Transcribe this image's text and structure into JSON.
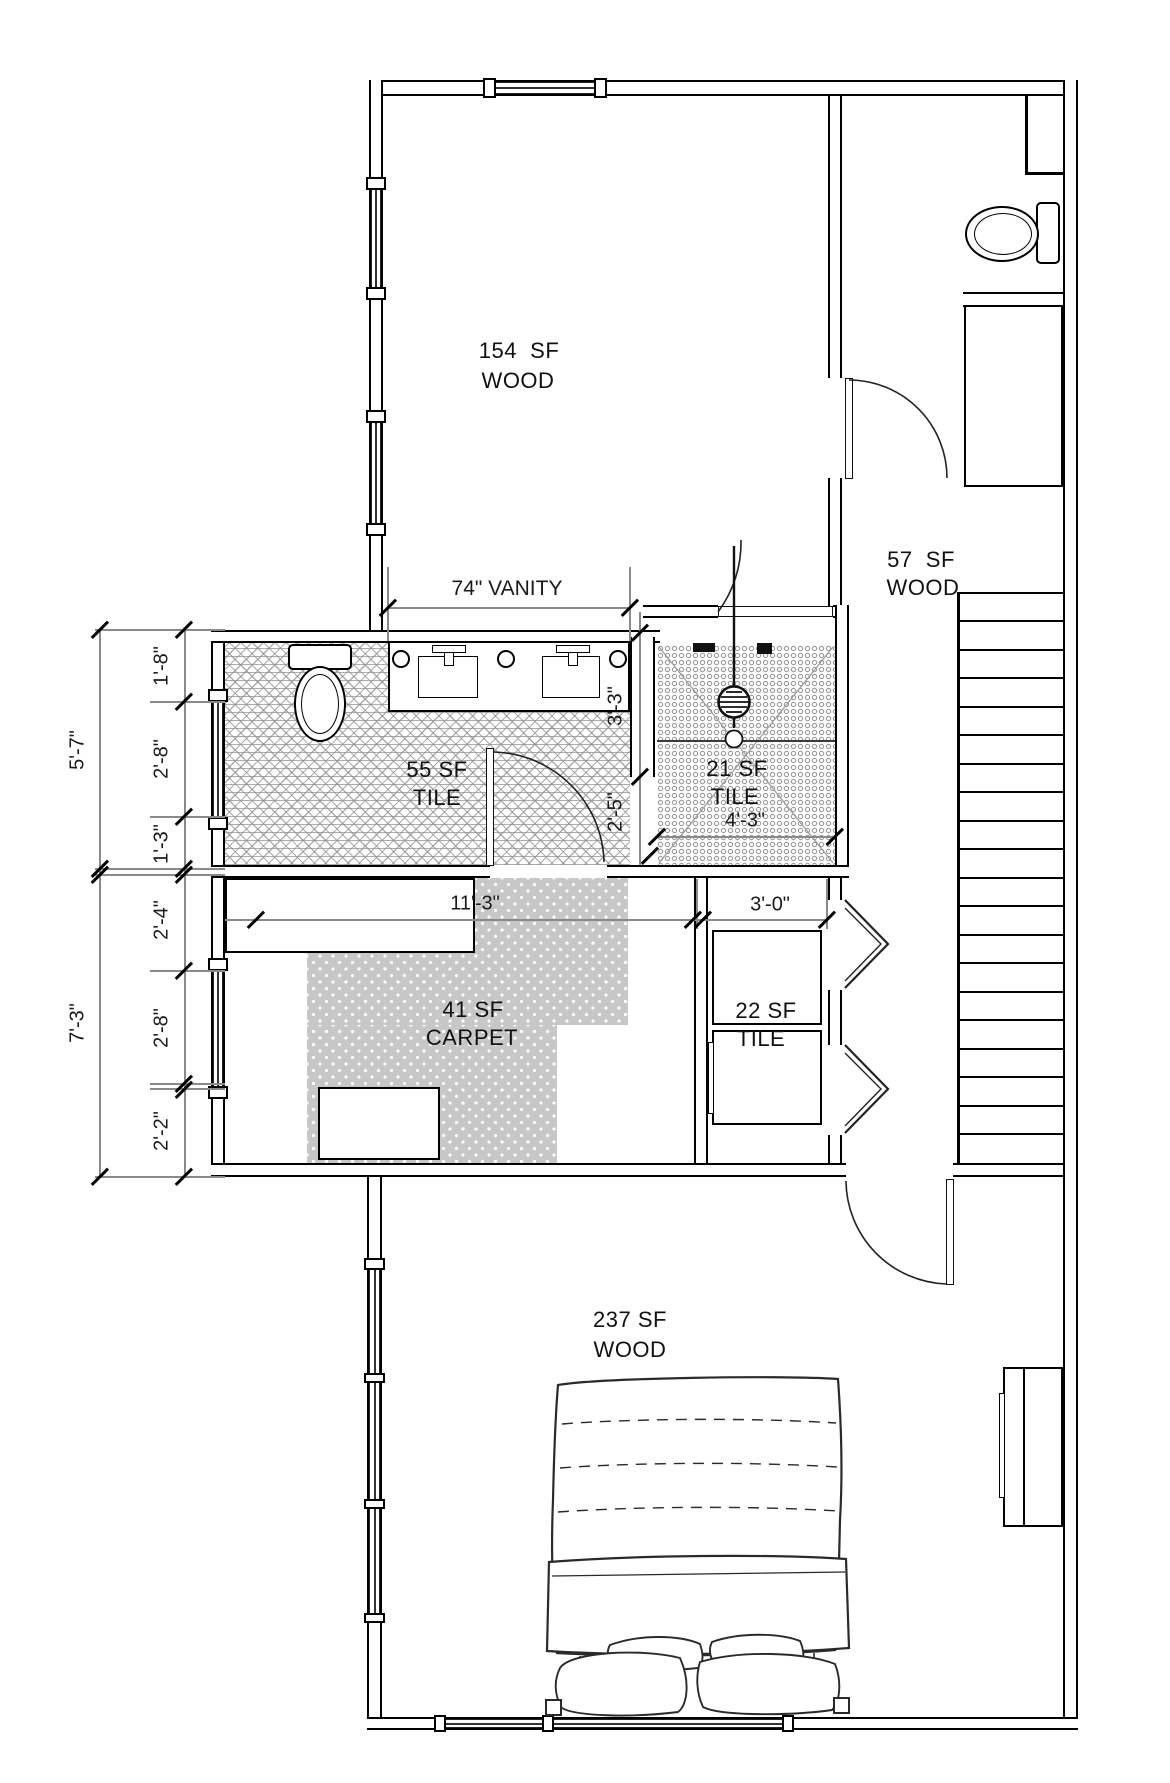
{
  "rooms": [
    {
      "area": "154  SF",
      "floor": "WOOD"
    },
    {
      "area": "57  SF",
      "floor": "WOOD"
    },
    {
      "area": "55 SF",
      "floor": "TILE"
    },
    {
      "area": "21 SF",
      "floor": "TILE"
    },
    {
      "area": "41 SF",
      "floor": "CARPET"
    },
    {
      "area": "22 SF",
      "floor": "TILE"
    },
    {
      "area": "237 SF",
      "floor": "WOOD"
    }
  ],
  "dims": {
    "vanity": "74\" VANITY",
    "left_outer_top": "5'-7\"",
    "left_outer_bottom": "7'-3\"",
    "left_inner": [
      "1'-8\"",
      "2'-8\"",
      "1'-3\"",
      "2'-4\"",
      "2'-8\"",
      "2'-2\""
    ],
    "bath_side_top": "3'-3\"",
    "bath_side_bottom": "2'-5\"",
    "closet_width": "11'-3\"",
    "laundry_width": "3'-0\"",
    "shower_width": "4'-3\""
  },
  "colors": {
    "line": "#000000",
    "tile_hatch": "#b5b5b5",
    "carpet": "#c7c7c7"
  }
}
